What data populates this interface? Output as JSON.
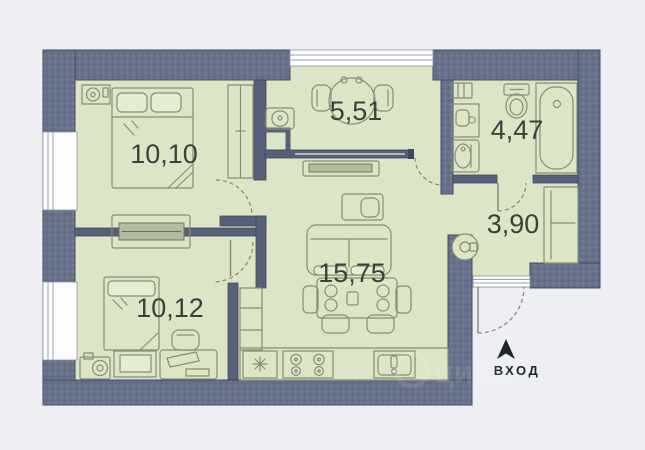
{
  "plan": {
    "type": "apartment-floor-plan",
    "entrance": {
      "label": "ВХОД"
    },
    "watermark": "циан",
    "rooms": [
      {
        "name": "bedroom-1",
        "area": "10,10"
      },
      {
        "name": "kitchen-niche",
        "area": "5,51"
      },
      {
        "name": "bathroom",
        "area": "4,47"
      },
      {
        "name": "hallway",
        "area": "3,90"
      },
      {
        "name": "living-room",
        "area": "15,75"
      },
      {
        "name": "bedroom-2",
        "area": "10,12"
      }
    ],
    "colors": {
      "background": "#edeff3",
      "wall": "#67718a",
      "wall_outline": "#414d63",
      "room_fill": "#dce6c6",
      "furniture_line": "#878e75",
      "label": "#3b403c",
      "window": "#fdfdfd"
    }
  }
}
